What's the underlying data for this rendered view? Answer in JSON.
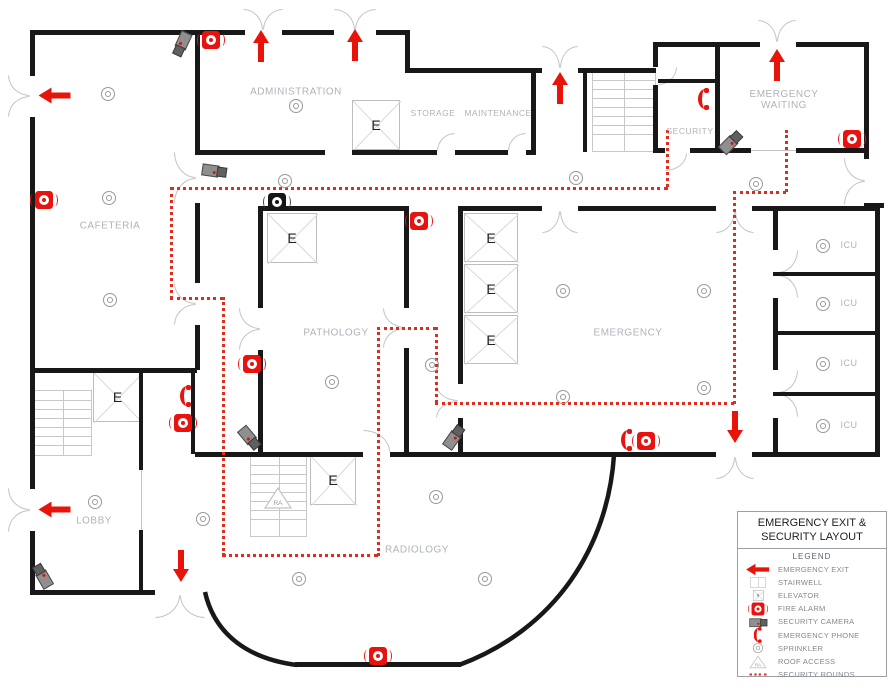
{
  "legend": {
    "title_line1": "EMERGENCY EXIT &",
    "title_line2": "SECURITY LAYOUT",
    "subtitle": "LEGEND",
    "items": [
      {
        "icon": "emergency-exit-icon",
        "label": "EMERGENCY EXIT"
      },
      {
        "icon": "stairwell-icon",
        "label": "STAIRWELL"
      },
      {
        "icon": "elevator-icon",
        "label": "ELEVATOR"
      },
      {
        "icon": "fire-alarm-icon",
        "label": "FIRE ALARM"
      },
      {
        "icon": "security-camera-icon",
        "label": "SECURITY CAMERA"
      },
      {
        "icon": "emergency-phone-icon",
        "label": "EMERGENCY PHONE"
      },
      {
        "icon": "sprinkler-icon",
        "label": "SPRINKLER"
      },
      {
        "icon": "roof-access-icon",
        "label": "ROOF ACCESS"
      },
      {
        "icon": "security-rounds-icon",
        "label": "SECURITY ROUNDS"
      }
    ]
  },
  "floorplan": {
    "rooms": [
      {
        "id": "administration",
        "label": "ADMINISTRATION",
        "x": 296,
        "y": 92
      },
      {
        "id": "storage",
        "label": "STORAGE",
        "x": 433,
        "y": 113
      },
      {
        "id": "maintenance",
        "label": "MAINTENANCE",
        "x": 498,
        "y": 113
      },
      {
        "id": "security",
        "label": "SECURITY",
        "x": 690,
        "y": 131
      },
      {
        "id": "emergency-waiting",
        "label": "EMERGENCY\nWAITING",
        "x": 784,
        "y": 100
      },
      {
        "id": "cafeteria",
        "label": "CAFETERIA",
        "x": 110,
        "y": 226
      },
      {
        "id": "pathology",
        "label": "PATHOLOGY",
        "x": 336,
        "y": 333
      },
      {
        "id": "emergency",
        "label": "EMERGENCY",
        "x": 628,
        "y": 333
      },
      {
        "id": "icu",
        "label": "ICU",
        "x": 849,
        "y": 245
      },
      {
        "id": "icu",
        "label": "ICU",
        "x": 849,
        "y": 303
      },
      {
        "id": "icu",
        "label": "ICU",
        "x": 849,
        "y": 363
      },
      {
        "id": "icu",
        "label": "ICU",
        "x": 849,
        "y": 425
      },
      {
        "id": "lobby",
        "label": "LOBBY",
        "x": 94,
        "y": 521
      },
      {
        "id": "radiology",
        "label": "RADIOLOGY",
        "x": 417,
        "y": 550
      }
    ],
    "elevators": [
      {
        "x": 352,
        "y": 100,
        "w": 48,
        "h": 50,
        "label": "E"
      },
      {
        "x": 267,
        "y": 213,
        "w": 50,
        "h": 50,
        "label": "E"
      },
      {
        "x": 93,
        "y": 372,
        "w": 49,
        "h": 50,
        "label": "E"
      },
      {
        "x": 464,
        "y": 213,
        "w": 54,
        "h": 49,
        "label": "E"
      },
      {
        "x": 464,
        "y": 264,
        "w": 54,
        "h": 49,
        "label": "E"
      },
      {
        "x": 464,
        "y": 315,
        "w": 54,
        "h": 49,
        "label": "E"
      },
      {
        "x": 310,
        "y": 455,
        "w": 46,
        "h": 50,
        "label": "E"
      }
    ],
    "stairwells": [
      {
        "x": 592,
        "y": 70,
        "w": 62,
        "h": 80
      },
      {
        "x": 33,
        "y": 390,
        "w": 57,
        "h": 64
      },
      {
        "x": 250,
        "y": 455,
        "w": 55,
        "h": 80
      }
    ],
    "roof_access": {
      "x": 263,
      "y": 486,
      "label": "RA"
    },
    "exit_arrows": [
      {
        "dir": "left",
        "x": 55,
        "y": 96
      },
      {
        "dir": "left",
        "x": 55,
        "y": 510
      },
      {
        "dir": "up",
        "x": 261,
        "y": 47
      },
      {
        "dir": "up",
        "x": 355,
        "y": 46
      },
      {
        "dir": "up",
        "x": 560,
        "y": 89
      },
      {
        "dir": "up",
        "x": 777,
        "y": 66
      },
      {
        "dir": "down",
        "x": 735,
        "y": 427
      },
      {
        "dir": "down",
        "x": 181,
        "y": 566
      }
    ],
    "fire_alarms": [
      {
        "x": 211,
        "y": 40
      },
      {
        "x": 44,
        "y": 200
      },
      {
        "x": 852,
        "y": 139
      },
      {
        "x": 419,
        "y": 221
      },
      {
        "x": 277,
        "y": 202,
        "variant": "dark"
      },
      {
        "x": 252,
        "y": 364
      },
      {
        "x": 183,
        "y": 423
      },
      {
        "x": 646,
        "y": 441
      },
      {
        "x": 378,
        "y": 656
      }
    ],
    "cameras": [
      {
        "x": 183,
        "y": 44,
        "rot": 115
      },
      {
        "x": 214,
        "y": 170,
        "rot": 8
      },
      {
        "x": 730,
        "y": 142,
        "rot": -45
      },
      {
        "x": 250,
        "y": 437,
        "rot": 50
      },
      {
        "x": 453,
        "y": 437,
        "rot": -55
      },
      {
        "x": 42,
        "y": 577,
        "rot": -120
      }
    ],
    "phones": [
      {
        "x": 704,
        "y": 99
      },
      {
        "x": 186,
        "y": 396
      },
      {
        "x": 627,
        "y": 440
      }
    ],
    "sprinklers": [
      {
        "x": 107,
        "y": 93
      },
      {
        "x": 108,
        "y": 197
      },
      {
        "x": 109,
        "y": 299
      },
      {
        "x": 295,
        "y": 105
      },
      {
        "x": 284,
        "y": 180
      },
      {
        "x": 575,
        "y": 177
      },
      {
        "x": 755,
        "y": 183
      },
      {
        "x": 431,
        "y": 364
      },
      {
        "x": 331,
        "y": 381
      },
      {
        "x": 562,
        "y": 290
      },
      {
        "x": 703,
        "y": 290
      },
      {
        "x": 562,
        "y": 396
      },
      {
        "x": 703,
        "y": 387
      },
      {
        "x": 822,
        "y": 245
      },
      {
        "x": 822,
        "y": 303
      },
      {
        "x": 822,
        "y": 363
      },
      {
        "x": 822,
        "y": 425
      },
      {
        "x": 94,
        "y": 501
      },
      {
        "x": 202,
        "y": 518
      },
      {
        "x": 298,
        "y": 578
      },
      {
        "x": 484,
        "y": 578
      },
      {
        "x": 435,
        "y": 496
      }
    ],
    "security_rounds": {
      "color": "#e02b1d",
      "segments": [
        {
          "dir": "h",
          "x": 170,
          "y": 187,
          "len": 498
        },
        {
          "dir": "v",
          "x": 666,
          "y": 130,
          "len": 57
        },
        {
          "dir": "v",
          "x": 170,
          "y": 187,
          "len": 112
        },
        {
          "dir": "h",
          "x": 170,
          "y": 297,
          "len": 53
        },
        {
          "dir": "v",
          "x": 222,
          "y": 297,
          "len": 259
        },
        {
          "dir": "h",
          "x": 222,
          "y": 554,
          "len": 156
        },
        {
          "dir": "v",
          "x": 377,
          "y": 327,
          "len": 229
        },
        {
          "dir": "h",
          "x": 377,
          "y": 327,
          "len": 59
        },
        {
          "dir": "v",
          "x": 435,
          "y": 327,
          "len": 76
        },
        {
          "dir": "h",
          "x": 435,
          "y": 402,
          "len": 299
        },
        {
          "dir": "v",
          "x": 733,
          "y": 191,
          "len": 213
        },
        {
          "dir": "h",
          "x": 733,
          "y": 191,
          "len": 53
        },
        {
          "dir": "v",
          "x": 785,
          "y": 130,
          "len": 62
        }
      ]
    },
    "colors": {
      "wall": "#181818",
      "accent_red": "#e8120e",
      "room_label": "#aeb3bb"
    }
  }
}
